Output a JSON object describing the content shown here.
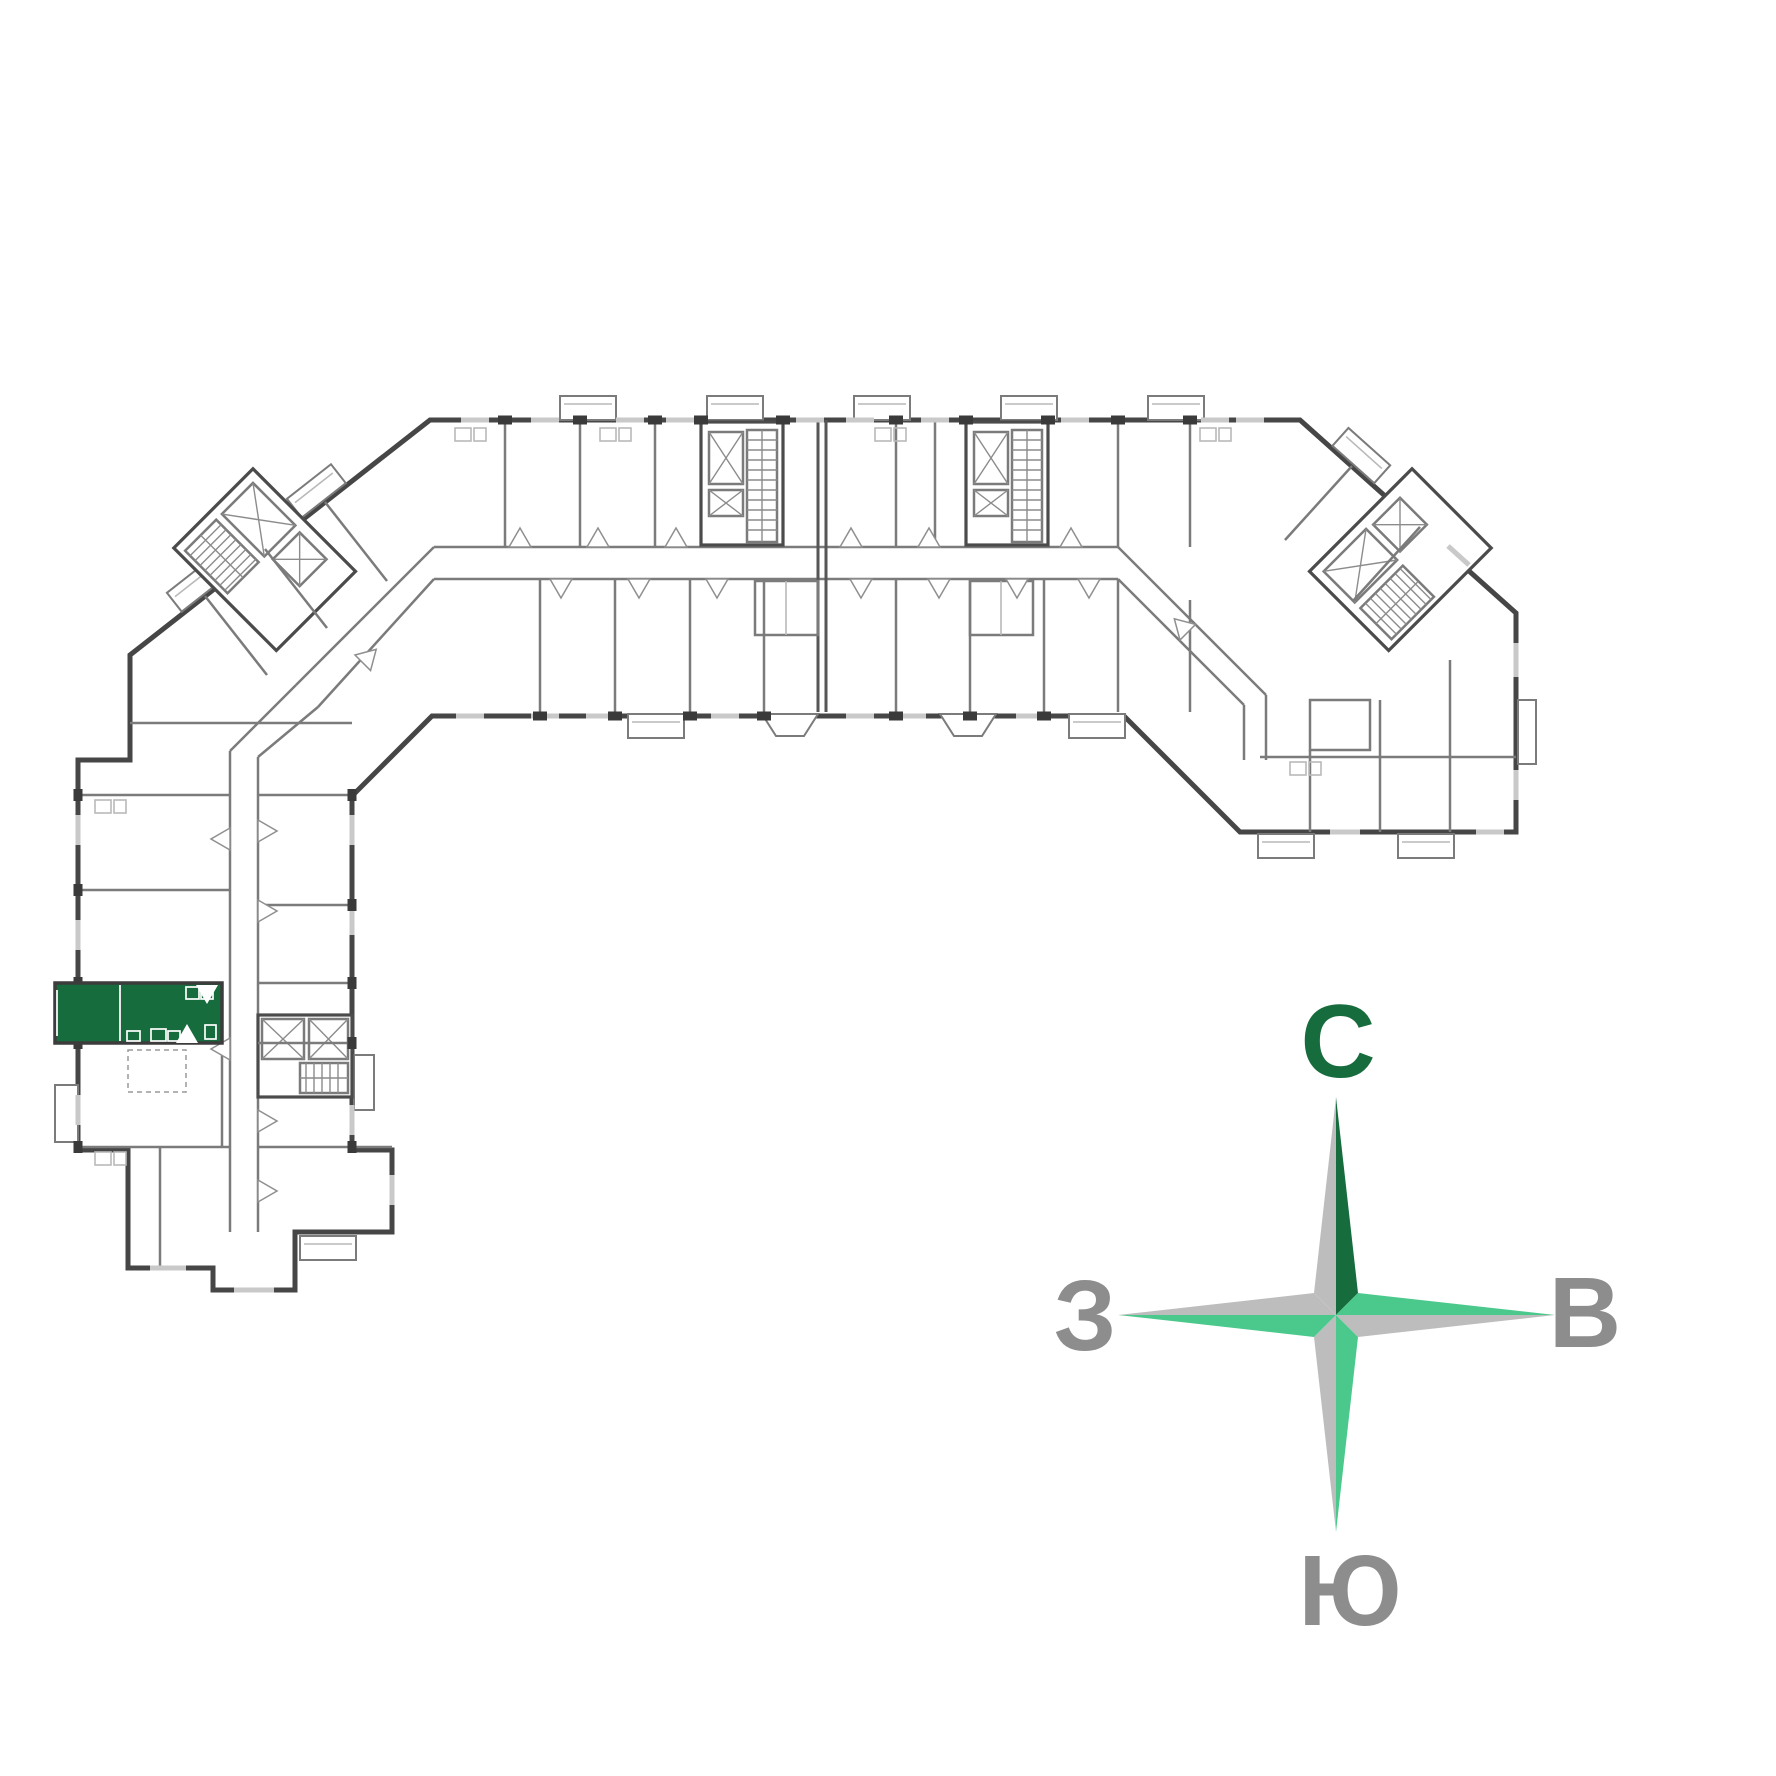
{
  "page": {
    "background": "#ffffff",
    "kind": "residential floor plan with compass rose"
  },
  "floorplan": {
    "highlighted_apartment": {
      "fill": "#176c3e",
      "wall": "#3c3c3c",
      "location": "left wing, west side"
    },
    "palette": {
      "outer_wall": "#464646",
      "partition": "#7b7b7b",
      "light_line": "#b9b9b9",
      "window": "#c9c9c9",
      "pier": "#3a3a3a"
    }
  },
  "compass": {
    "north": {
      "label": "С",
      "color": "#176c3e"
    },
    "east": {
      "label": "В",
      "color": "#8d8d8d"
    },
    "south": {
      "label": "Ю",
      "color": "#8d8d8d"
    },
    "west": {
      "label": "З",
      "color": "#8d8d8d"
    },
    "star": {
      "gray": "#bdbdbd",
      "dark_green": "#176c3e",
      "green": "#4bc88c"
    }
  }
}
